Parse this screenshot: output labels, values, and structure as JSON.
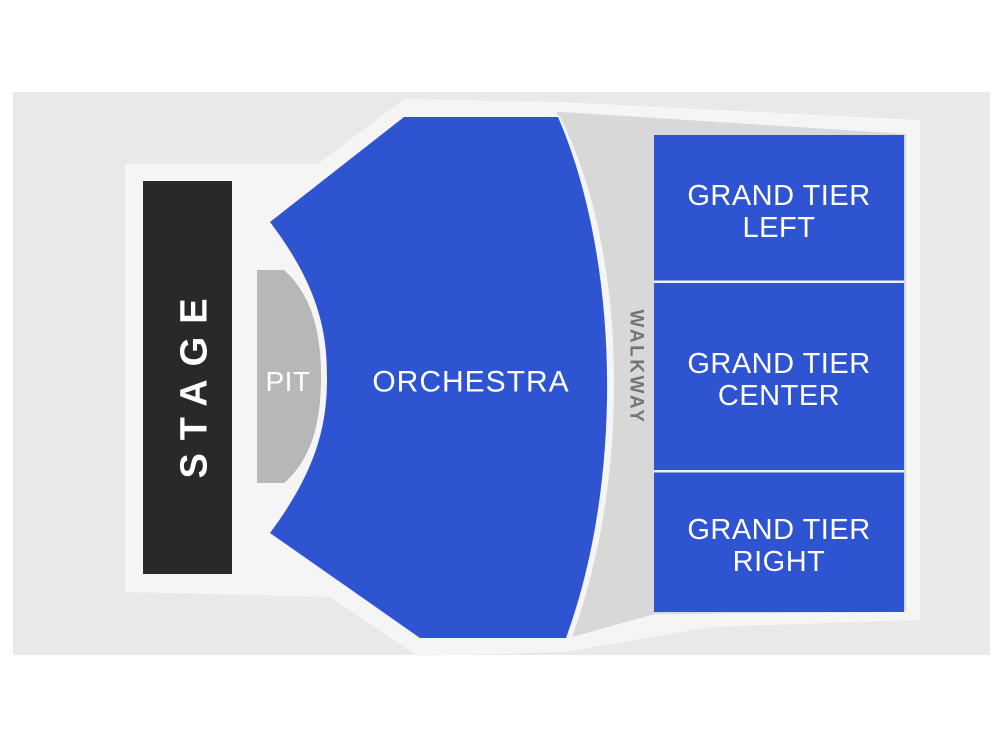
{
  "title": "Venue seating chart",
  "colors": {
    "page_bg": "#FFFFFF",
    "panel_bg": "#E9E9E9",
    "floor": "#F5F5F6",
    "walkway_band": "#D8D8D8",
    "section_blue": "#2E54D2",
    "stage_dark": "#292929",
    "pit_gray": "#B7B7B7",
    "separator": "#EEF0F4",
    "label_white": "#FFFFFF",
    "walkway_text_gray": "#757575"
  },
  "sections": {
    "stage": {
      "label": "STAGE"
    },
    "pit": {
      "label": "PIT"
    },
    "orchestra": {
      "label": "ORCHESTRA"
    },
    "walkway": {
      "label": "WALKWAY"
    },
    "grand_tier_left": {
      "line1": "GRAND TIER",
      "line2": "LEFT"
    },
    "grand_tier_center": {
      "line1": "GRAND TIER",
      "line2": "CENTER"
    },
    "grand_tier_right": {
      "line1": "GRAND TIER",
      "line2": "RIGHT"
    }
  }
}
